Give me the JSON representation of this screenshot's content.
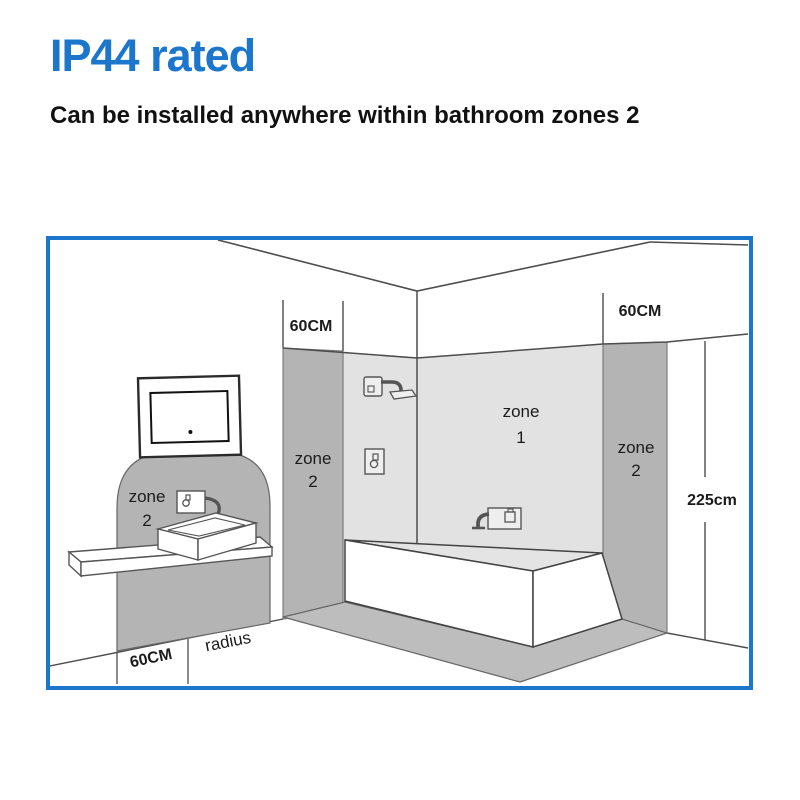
{
  "title": "IP44 rated",
  "subtitle": "Can be installed anywhere within bathroom zones 2",
  "colors": {
    "accent_blue": "#1b76cc",
    "zone_light_gray": "#e2e2e2",
    "zone_dark_gray": "#b4b4b4",
    "floor_band_gray": "#bdbdbd",
    "line_gray": "#4d4d4d"
  },
  "diagram": {
    "zone_labels": {
      "sink": {
        "word": "zone",
        "num": "2"
      },
      "shower_side_wall": {
        "word": "zone",
        "num": "2"
      },
      "bath_back_wall": {
        "word": "zone",
        "num": "1"
      },
      "right_wall": {
        "word": "zone",
        "num": "2"
      }
    },
    "measurements": {
      "shower_zone_width": "60CM",
      "right_zone_width": "60CM",
      "floor_zone_width": "60CM",
      "floor_radius_label": "radius",
      "zone_height": "225cm"
    },
    "icons": [
      "led-mirror-icon",
      "basin-mixer-icon",
      "shower-head-icon",
      "shower-valve-icon",
      "bath-filler-icon",
      "bathtub-icon",
      "wash-basin-icon",
      "shelf-icon"
    ]
  }
}
